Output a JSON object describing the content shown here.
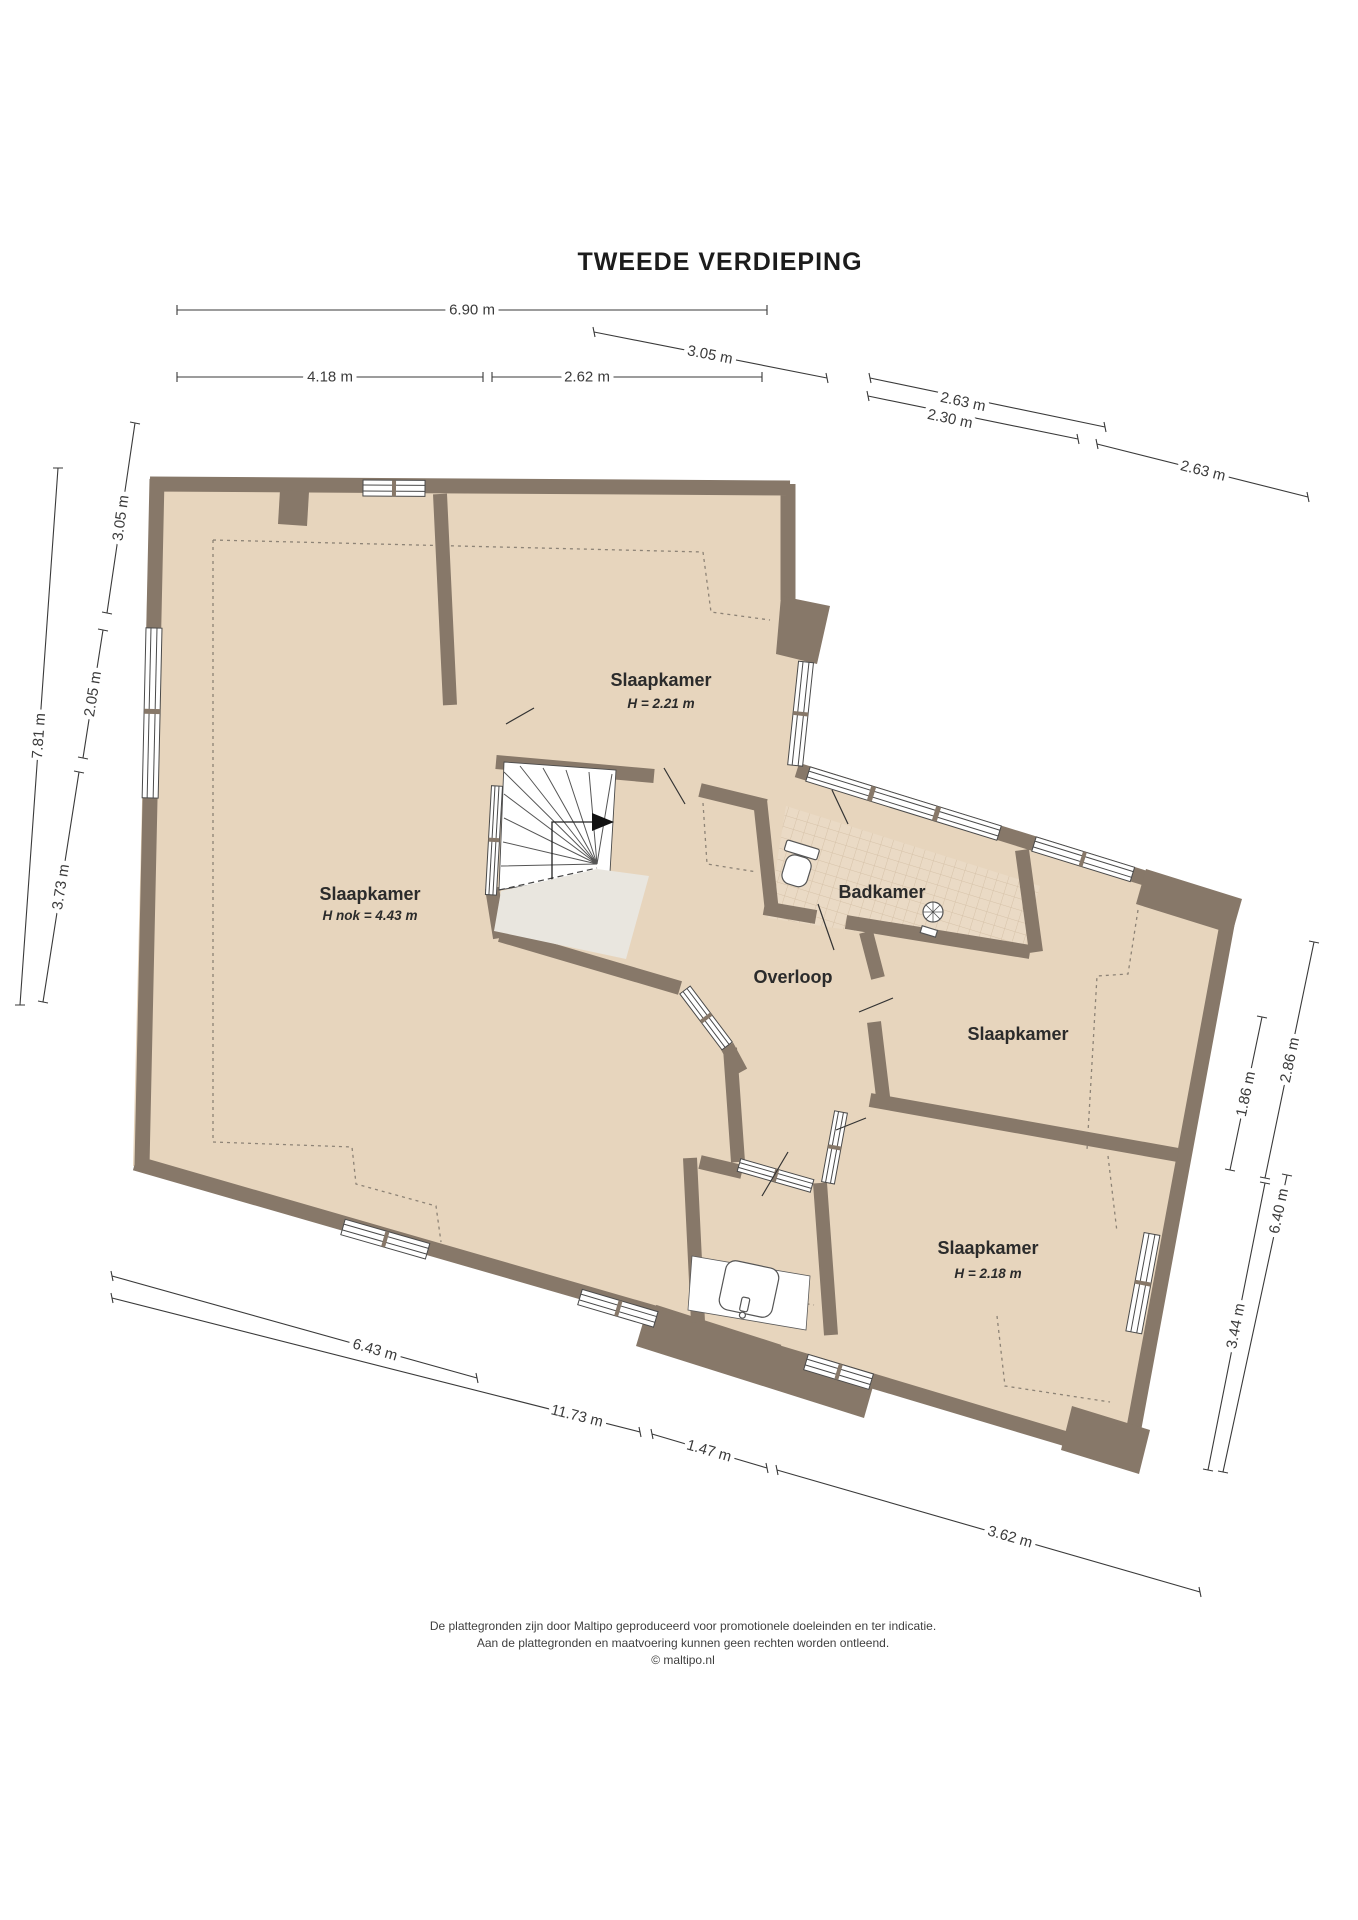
{
  "title": "TWEEDE VERDIEPING",
  "colors": {
    "paper": "#ffffff",
    "wall": "#877869",
    "floor": "#e7d5bd",
    "tile": "#eadac5",
    "tileline": "#d6c2a9",
    "voidfill": "#e9e6df",
    "dimcolor": "#3a3a3a",
    "labelcolor": "#2b2b2b",
    "footercolor": "#3f3f3f",
    "fixline": "#555555",
    "dashcolor": "#8d8376"
  },
  "rooms": {
    "bedroom_large": {
      "label": "Slaapkamer",
      "height_note": "H nok = 4.43 m"
    },
    "bedroom_top": {
      "label": "Slaapkamer",
      "height_note": "H = 2.21 m"
    },
    "bathroom": {
      "label": "Badkamer"
    },
    "landing": {
      "label": "Overloop"
    },
    "bedroom_right": {
      "label": "Slaapkamer"
    },
    "bedroom_bottom": {
      "label": "Slaapkamer",
      "height_note": "H = 2.18 m"
    }
  },
  "dims": {
    "d1": {
      "label": "6.90 m"
    },
    "d2": {
      "label": "4.18 m"
    },
    "d3": {
      "label": "2.62 m"
    },
    "d4": {
      "label": "3.05 m"
    },
    "d5": {
      "label": "2.63 m"
    },
    "d6": {
      "label": "2.30 m"
    },
    "d7": {
      "label": "2.63 m"
    },
    "d8": {
      "label": "3.05 m"
    },
    "d9": {
      "label": "7.81 m"
    },
    "d10": {
      "label": "2.05 m"
    },
    "d11": {
      "label": "3.73 m"
    },
    "d12": {
      "label": "2.86 m"
    },
    "d13": {
      "label": "1.86 m"
    },
    "d14": {
      "label": "6.40 m"
    },
    "d15": {
      "label": "3.44 m"
    },
    "d16": {
      "label": "6.43 m"
    },
    "d17": {
      "label": "11.73 m"
    },
    "d18": {
      "label": "1.47 m"
    },
    "d19": {
      "label": "3.62 m"
    }
  },
  "footer": {
    "line1": "De plattegronden zijn door Maltipo geproduceerd voor promotionele doeleinden en ter indicatie.",
    "line2": "Aan de plattegronden en maatvoering kunnen geen rechten worden ontleend.",
    "line3": "© maltipo.nl"
  }
}
